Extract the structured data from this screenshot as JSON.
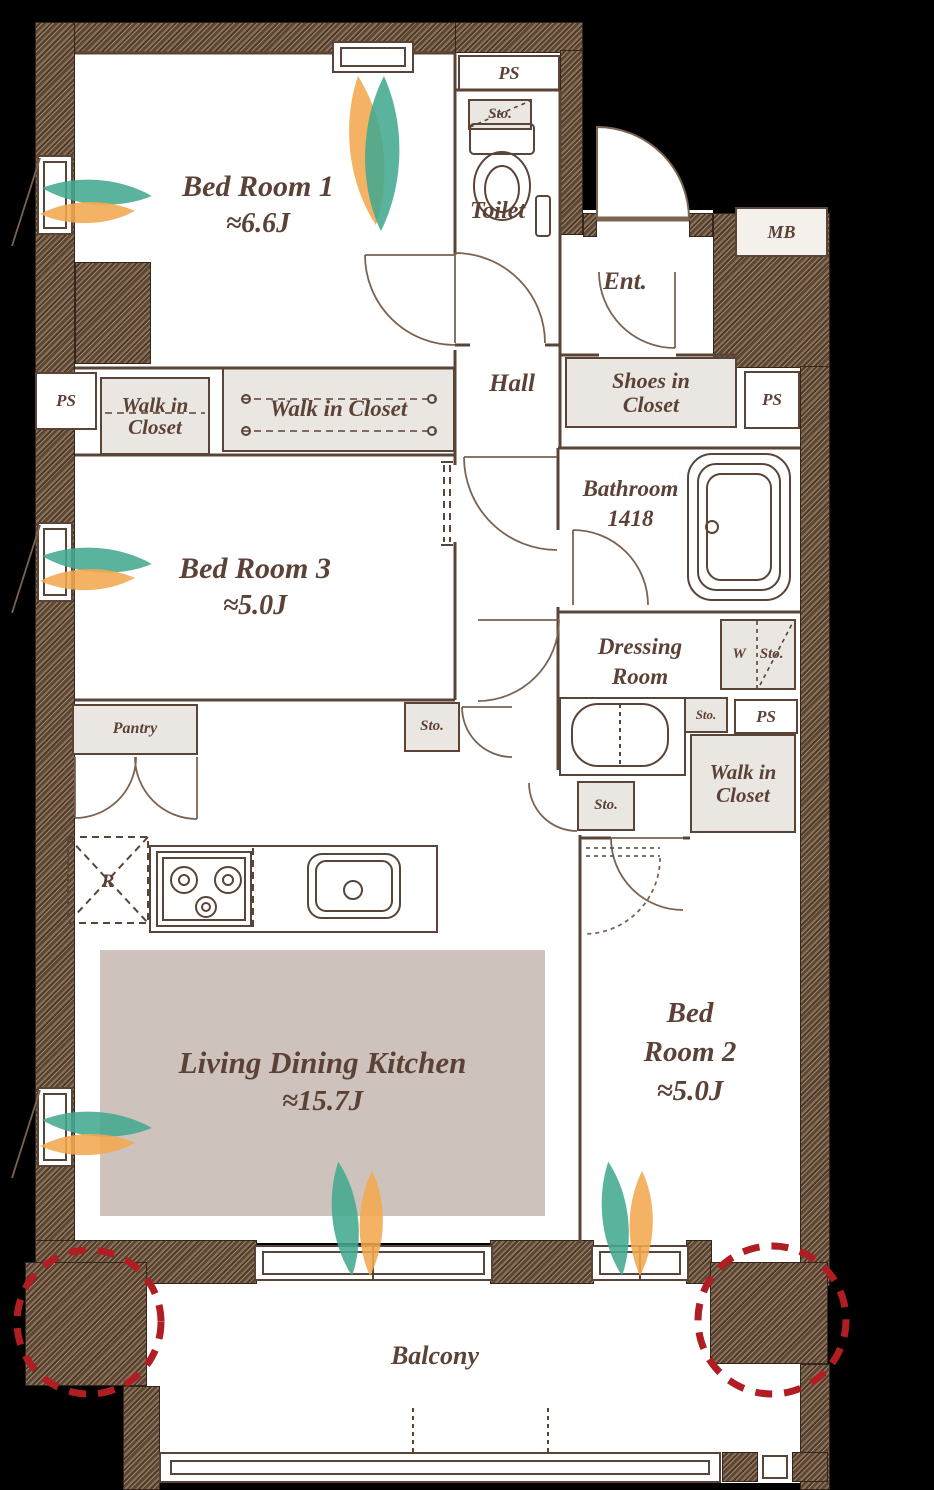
{
  "colors": {
    "background": "#000000",
    "floor": "#ffffff",
    "line": "#5a4437",
    "text": "#5c4236",
    "closet_fill": "#eae6e1",
    "ldk_fill": "#cec3bc",
    "accent_red": "#b01e23",
    "leaf_green": "#43a990",
    "leaf_orange": "#f2a94f"
  },
  "rooms": {
    "bedroom1": {
      "name": "Bed Room 1",
      "size": "≈6.6J"
    },
    "bedroom2": {
      "line1": "Bed",
      "line2": "Room 2",
      "size": "≈5.0J"
    },
    "bedroom3": {
      "name": "Bed Room 3",
      "size": "≈5.0J"
    },
    "ldk": {
      "name": "Living Dining Kitchen",
      "size": "≈15.7J"
    },
    "toilet": {
      "name": "Toilet"
    },
    "hall": {
      "name": "Hall"
    },
    "entrance": {
      "name": "Ent."
    },
    "bathroom": {
      "line1": "Bathroom",
      "line2": "1418"
    },
    "dressing": {
      "line1": "Dressing",
      "line2": "Room"
    },
    "balcony": {
      "name": "Balcony"
    }
  },
  "closets": {
    "walk_in_line1": "Walk in",
    "walk_in_line2": "Closet",
    "walk_in_closet": "Walk in Closet",
    "shoes_line1": "Shoes in",
    "shoes_line2": "Closet",
    "pantry": "Pantry",
    "storage": "Sto.",
    "washer": "W",
    "refrigerator": "R"
  },
  "service": {
    "pipe_space": "PS",
    "meter_box": "MB"
  }
}
